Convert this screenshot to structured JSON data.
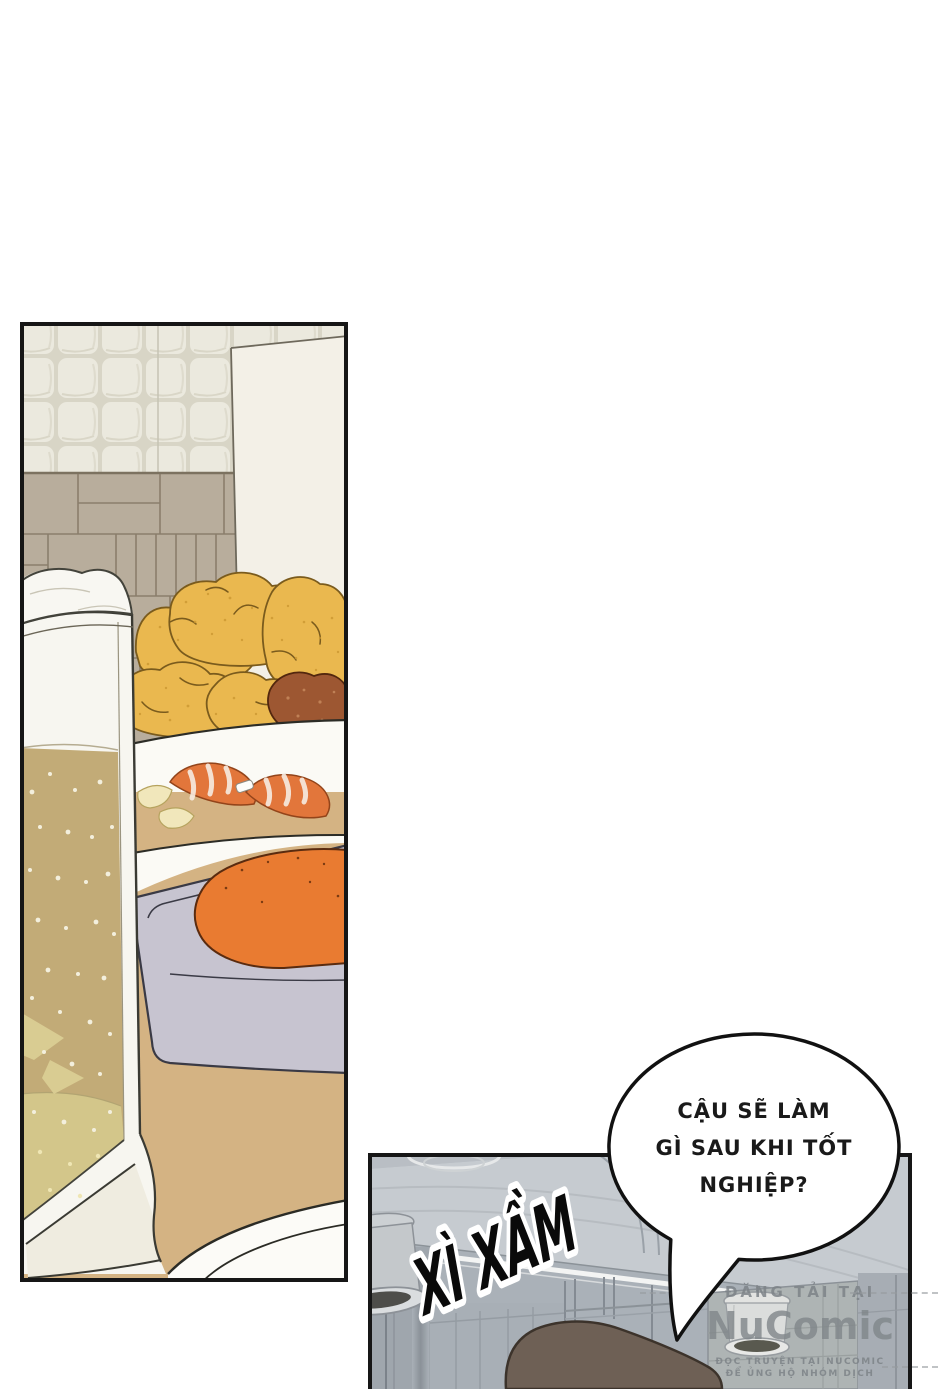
{
  "speech_bubble": {
    "lines": [
      "CẬU SẼ LÀM",
      "GÌ SAU KHI TỐT",
      "NGHIỆP?"
    ]
  },
  "sfx": {
    "text": "XÌ XẦM"
  },
  "watermark": {
    "tagline": "ĐĂNG TẢI TẠI",
    "logo": "NuComic",
    "subline1": "ĐỌC TRUYỆN TẠI NUCOMIC",
    "subline2": "ĐỂ ỦNG HỘ NHÓM DỊCH"
  },
  "colors": {
    "page_bg": "#ffffff",
    "panel_border": "#161616",
    "tile_wall": "#e9e6dc",
    "wood_wall": "#b8ad9c",
    "menu_board": "#f3f0e7",
    "beer": "#c2ab77",
    "beer_light": "#d3c68a",
    "foam": "#f8f7f2",
    "fried_chicken": "#eab84f",
    "dark_chicken": "#9d5732",
    "shrimp": "#e2763b",
    "lemon": "#f1e7bb",
    "sausage": "#e97b31",
    "tray": "#c7c4d0",
    "table": "#d4b383",
    "bar_background": "#aab1b8",
    "bar_ceiling_duct": "#c6cbd0",
    "hair_silhouette": "#6e6055",
    "watermark_gray": "#82888c"
  }
}
